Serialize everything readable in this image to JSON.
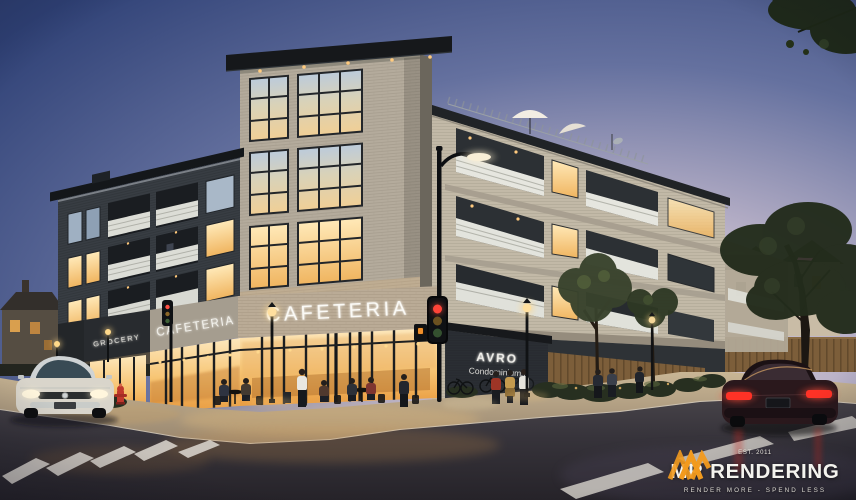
{
  "scene": {
    "description": "Architectural exterior rendering of a four-storey mixed-use condominium building on a street corner at dusk, with lit cafeteria storefront, outdoor diners, street lamps, traffic lights, a white car and a dark red car, crosswalks and trees"
  },
  "signs": {
    "grocery": "GROCERY",
    "cafeteria_side": "CAFETERIA",
    "cafeteria_front": "CAFETERIA",
    "building_name": "AVRO",
    "building_subtitle": "Condominiums"
  },
  "logo": {
    "name": "MR RENDERING",
    "est": "EST. 2011",
    "tagline": "RENDER MORE - SPEND LESS",
    "accent_color": "#f29a1e"
  },
  "palette": {
    "sky_top": "#2f4176",
    "sky_horizon": "#e6d7d6",
    "brick_light": "#b4ab9c",
    "brick_dark": "#383d43",
    "storefront_glow": "#f7c472",
    "asphalt": "#302c2f",
    "sidewalk": "#b7a48a",
    "signal_red": "#ff4438",
    "taillight_red": "#ff3226",
    "foliage": "#2c3623"
  }
}
